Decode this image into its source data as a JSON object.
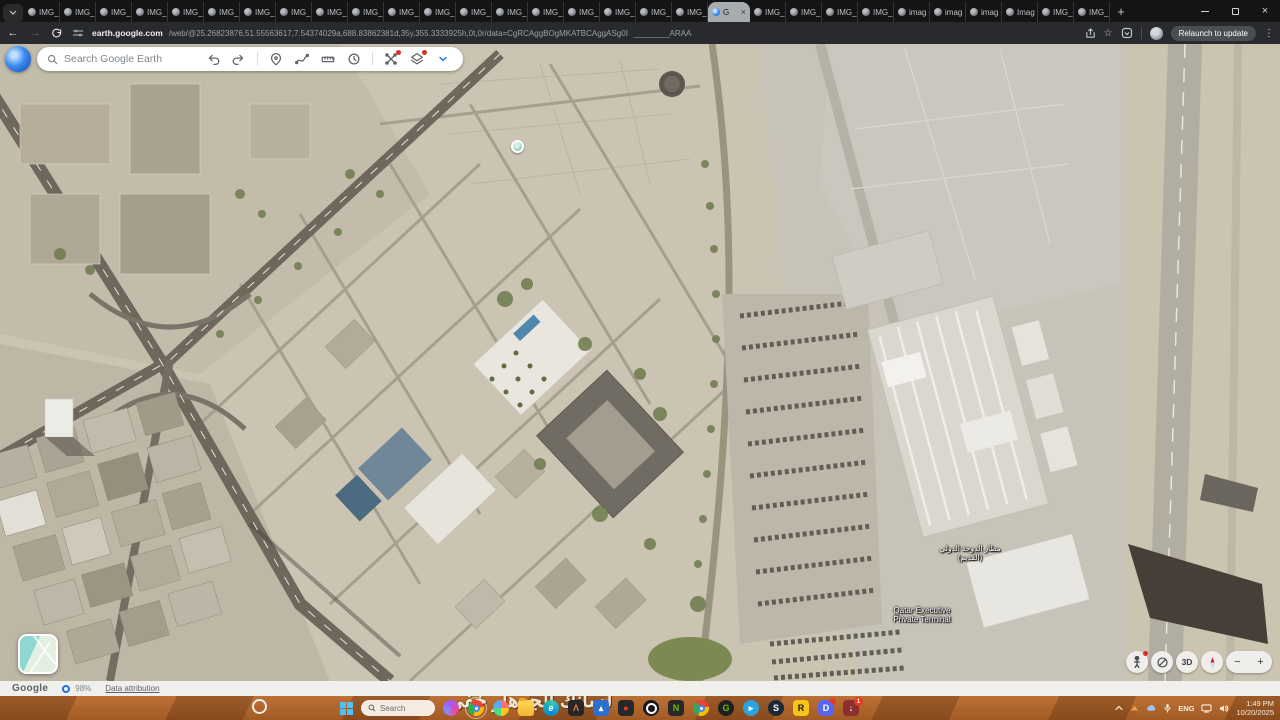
{
  "accent_colors": {
    "chrome_blue": "#1a73e8",
    "alert_red": "#d93025",
    "taskbar_orange": "#b2672f"
  },
  "browser": {
    "active_tab_close": "×",
    "tabs": [
      {
        "label": "IMG_"
      },
      {
        "label": "IMG_"
      },
      {
        "label": "IMG_"
      },
      {
        "label": "IMG_"
      },
      {
        "label": "IMG_"
      },
      {
        "label": "IMG_"
      },
      {
        "label": "IMG_"
      },
      {
        "label": "IMG_"
      },
      {
        "label": "IMG_"
      },
      {
        "label": "IMG_"
      },
      {
        "label": "IMG_"
      },
      {
        "label": "IMG_"
      },
      {
        "label": "IMG_"
      },
      {
        "label": "IMG_"
      },
      {
        "label": "IMG_"
      },
      {
        "label": "IMG_"
      },
      {
        "label": "IMG_"
      },
      {
        "label": "IMG_"
      },
      {
        "label": "IMG_"
      },
      {
        "label": "G",
        "active": true
      },
      {
        "label": "IMG_"
      },
      {
        "label": "IMG_"
      },
      {
        "label": "IMG_"
      },
      {
        "label": "IMG_"
      },
      {
        "label": "imag"
      },
      {
        "label": "imag"
      },
      {
        "label": "imag"
      },
      {
        "label": "Imag"
      },
      {
        "label": "IMG_"
      },
      {
        "label": "IMG_"
      }
    ],
    "new_tab_button": "+",
    "nav_back": "←",
    "nav_forward": "→",
    "url_host": "earth.google.com",
    "url_path": "/web/@25.26823876,51.55563617,7.54374029a,688.83862381d,35y,355.3333925h,0t,0r/data=CgRCAggBOgMKATBCAggASg0I",
    "url_suffix": "________ARAA",
    "relaunch_label": "Relaunch to update",
    "kebab": "⋮",
    "bookmark_star": "☆"
  },
  "earth": {
    "search_placeholder": "Search Google Earth",
    "labels": {
      "airport_ar_1": "مطار الدوحة الدولي",
      "airport_ar_2": "(القديم)",
      "terminal_1": "Qatar Executive",
      "terminal_2": "Private Terminal"
    },
    "controls": {
      "mode_3d": "3D",
      "zoom_in": "+",
      "zoom_out": "−"
    },
    "status": {
      "brand": "Google",
      "load_percent": "98%",
      "attribution_link": "Data attribution"
    }
  },
  "desktop": {
    "wallpaper_text": "لسانك الجرهار خفي",
    "taskbar": {
      "search_placeholder": "Search",
      "apps": [
        {
          "name": "app-clipchamp",
          "cls": "swirl"
        },
        {
          "name": "app-chrome",
          "cls": "chrome",
          "core": true,
          "active": true
        },
        {
          "name": "app-photos",
          "cls": "photos"
        },
        {
          "name": "app-file-explorer",
          "cls": "folder"
        },
        {
          "name": "app-edge",
          "cls": "edge",
          "glyph": "e"
        },
        {
          "name": "app-autodesk",
          "cls": "dark",
          "glyph": "Λ",
          "fg": "#f0793a"
        },
        {
          "name": "app-gallery",
          "cls": "blue",
          "glyph": "▴"
        },
        {
          "name": "app-recorder",
          "cls": "dark",
          "glyph": "●",
          "fg": "#e8391f"
        },
        {
          "name": "app-obs",
          "cls": "obs"
        },
        {
          "name": "app-nvidia",
          "cls": "dark",
          "glyph": "N",
          "fg": "#76b900"
        },
        {
          "name": "app-chrome-2",
          "cls": "chrome",
          "core": true
        },
        {
          "name": "app-geforce",
          "cls": "darkround",
          "glyph": "G",
          "fg": "#76b900"
        },
        {
          "name": "app-telegram",
          "cls": "tg",
          "glyph": "▸"
        },
        {
          "name": "app-steam",
          "cls": "steam",
          "glyph": "S"
        },
        {
          "name": "app-rockstar",
          "cls": "rock",
          "glyph": "R"
        },
        {
          "name": "app-discord",
          "cls": "discord",
          "glyph": "D",
          "dot": true
        },
        {
          "name": "app-downloads",
          "cls": "dl",
          "glyph": "↓",
          "badge": "1"
        }
      ],
      "tray_language": "ENG",
      "clock_time": "1:49 PM",
      "clock_date": "10/20/2025"
    }
  }
}
